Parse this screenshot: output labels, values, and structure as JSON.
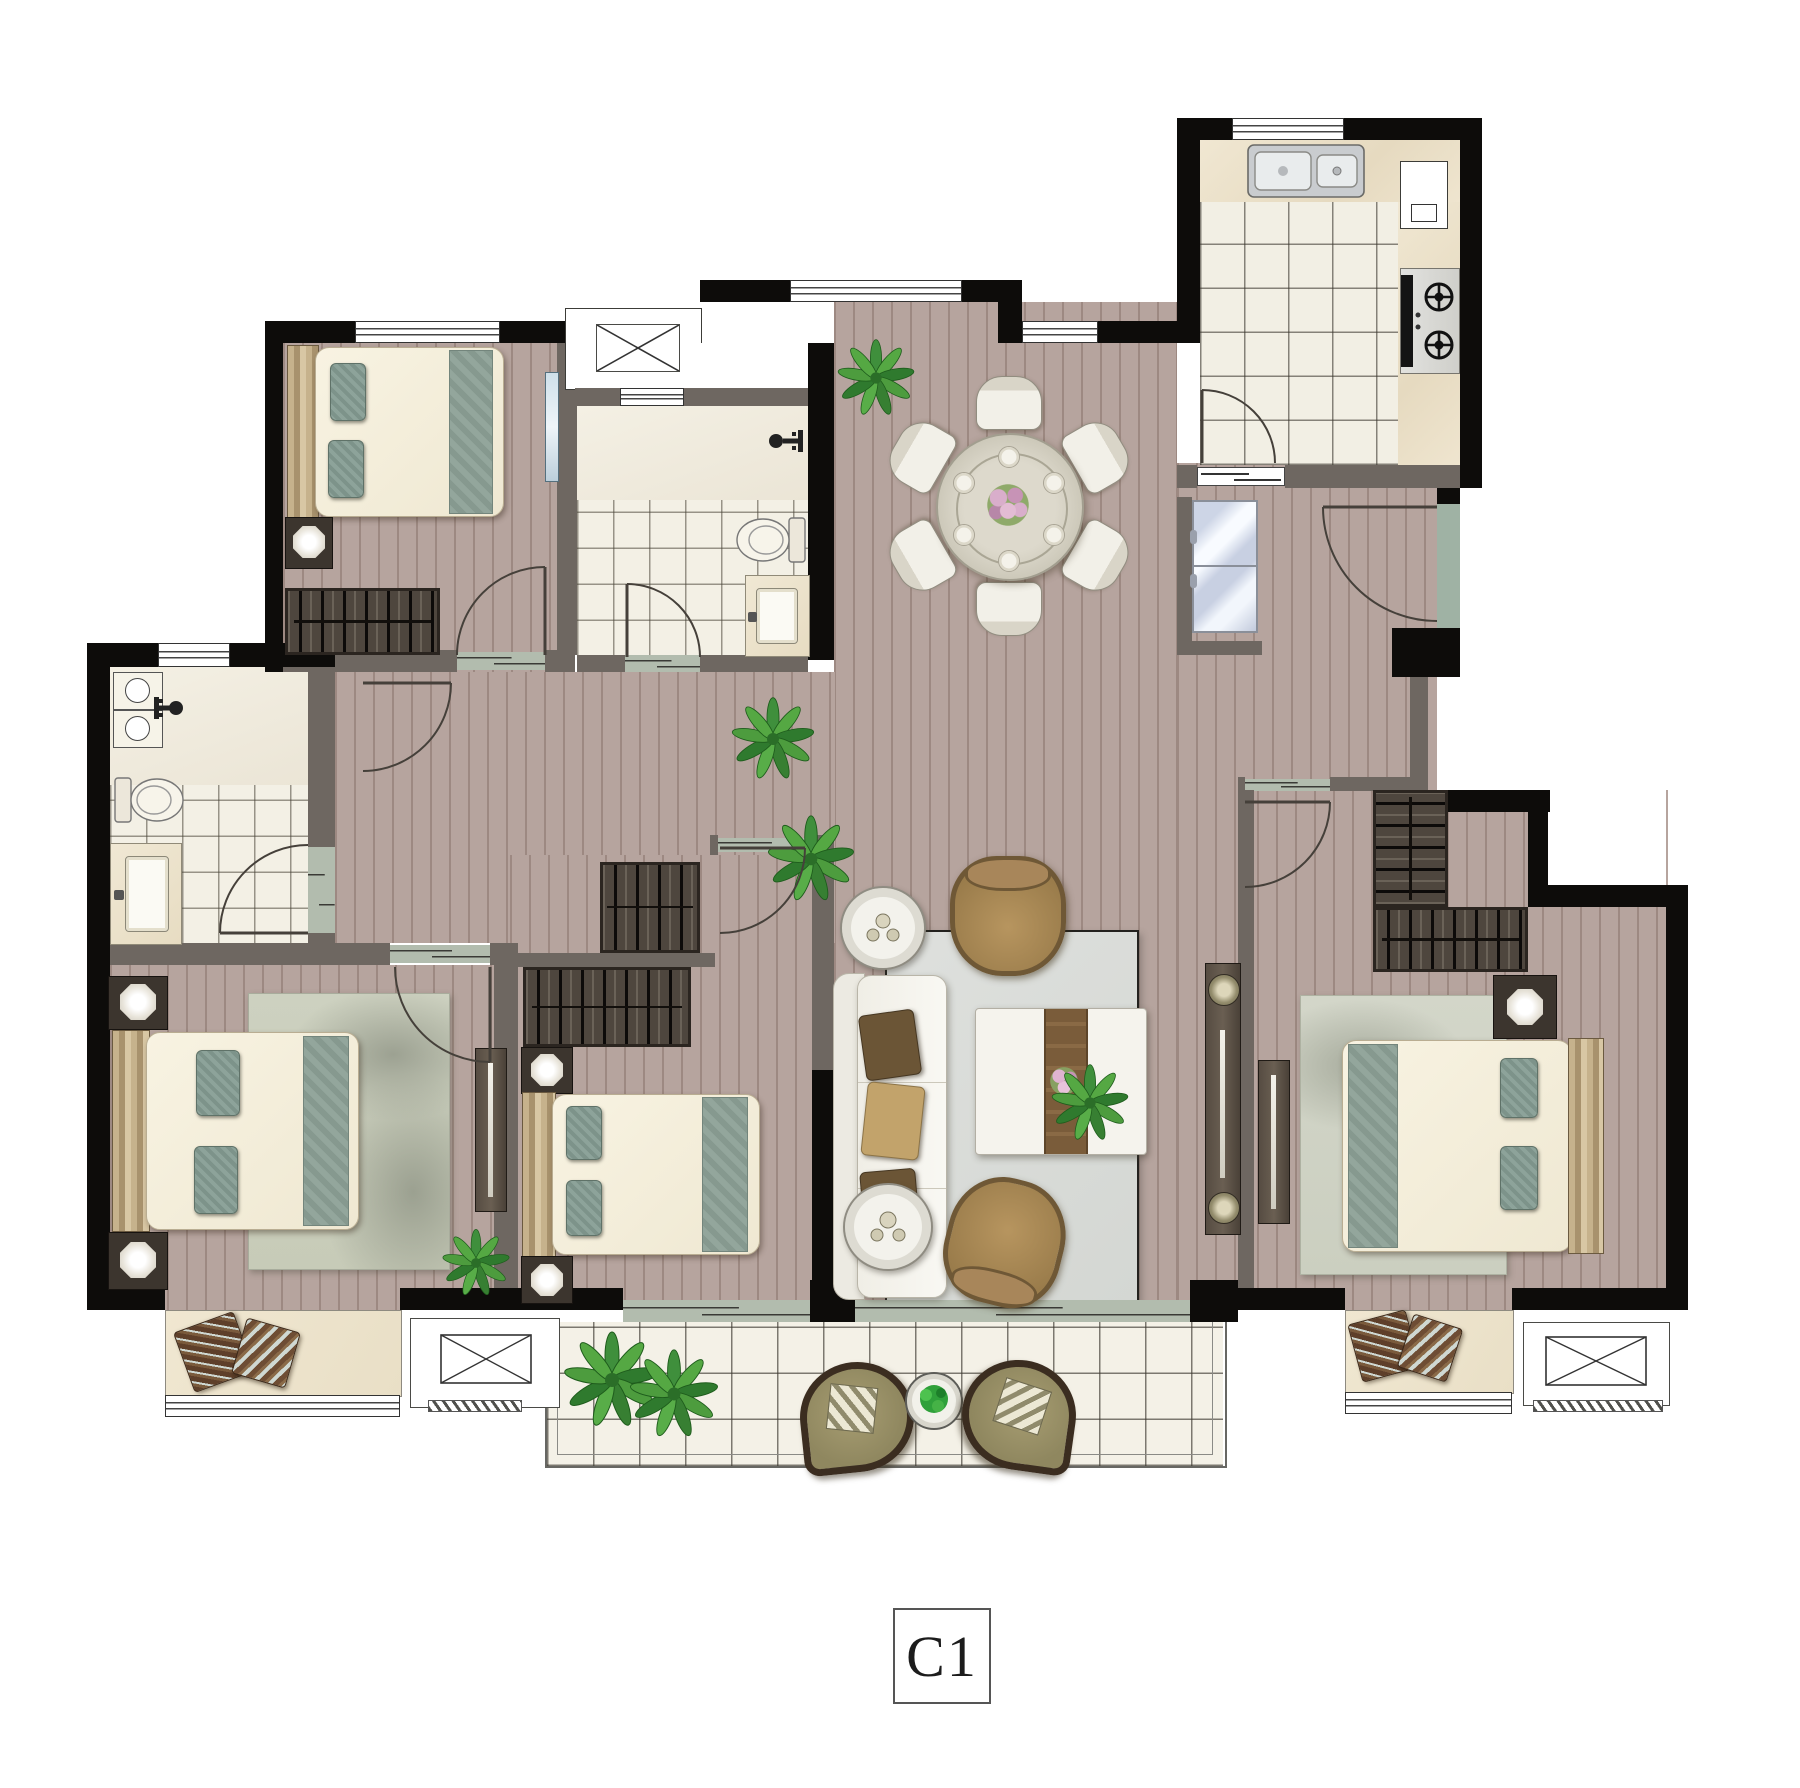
{
  "plan": {
    "unit_label": "C1",
    "kind": "apartment-floor-plan",
    "palette": {
      "structural_wall": "#0d0c0a",
      "partition_wall": "#6e6761",
      "wood_floor": "#b6a49e",
      "tile_floor": "#f3f0e5",
      "counter": "#eee4cf",
      "accent_teal": "#93a69c",
      "sofa_white": "#f7f6f1",
      "armchair_tan": "#a8865a",
      "living_rug": "#dcdedb",
      "plant_green": "#3f8f3c",
      "threshold_marble": "#b2bcae"
    },
    "rooms": [
      {
        "name": "bedroom-top-left",
        "items": [
          "double-bed",
          "teal-pillows",
          "nightstand",
          "table-lamp",
          "wardrobe",
          "wall-mirror",
          "window",
          "door"
        ]
      },
      {
        "name": "bathroom-center",
        "items": [
          "shower-area",
          "shower-faucet",
          "toilet",
          "vanity-sink",
          "window",
          "door",
          "vent-shaft"
        ]
      },
      {
        "name": "dining-room",
        "items": [
          "round-dining-table",
          "six-dining-chairs",
          "flower-centerpiece",
          "place-settings",
          "potted-plant",
          "window"
        ]
      },
      {
        "name": "kitchen",
        "items": [
          "double-basin-sink",
          "two-burner-gas-stove",
          "l-counter",
          "wall-cabinet",
          "refrigerator",
          "sliding-door",
          "swing-door",
          "window"
        ]
      },
      {
        "name": "entry-hall",
        "items": [
          "entry-door",
          "stone-threshold"
        ]
      },
      {
        "name": "bathroom-left",
        "items": [
          "washing-machine",
          "shower-faucet",
          "toilet",
          "vanity-sink",
          "window",
          "door"
        ]
      },
      {
        "name": "bedroom-bottom-left",
        "items": [
          "double-bed",
          "two-nightstands",
          "table-lamps",
          "patterned-rug",
          "dresser",
          "potted-plant",
          "bay-window-seat",
          "decor-pillows",
          "door"
        ]
      },
      {
        "name": "bedroom-middle",
        "items": [
          "double-bed",
          "two-nightstands",
          "table-lamps",
          "wardrobe",
          "balcony-sliding-door",
          "door"
        ]
      },
      {
        "name": "living-room",
        "items": [
          "three-seat-sofa",
          "sofa-pillows",
          "two-armchairs",
          "coffee-table",
          "flower-decor",
          "two-round-side-tables",
          "area-rug",
          "tv-console",
          "potted-plants",
          "balcony-sliding-door"
        ]
      },
      {
        "name": "bedroom-right",
        "items": [
          "double-bed",
          "nightstand",
          "table-lamp",
          "l-shaped-wardrobe",
          "dresser",
          "area-rug",
          "bay-window-seat",
          "decor-pillows",
          "door"
        ]
      },
      {
        "name": "balcony",
        "items": [
          "two-lounge-chairs",
          "striped-pillows",
          "round-side-table",
          "potted-plants",
          "railing",
          "tile-floor"
        ]
      },
      {
        "name": "service",
        "items": [
          "vent-shaft-x-symbol",
          "ac-platform-left",
          "ac-platform-right",
          "hallway-closet",
          "hallway-door"
        ]
      }
    ]
  }
}
